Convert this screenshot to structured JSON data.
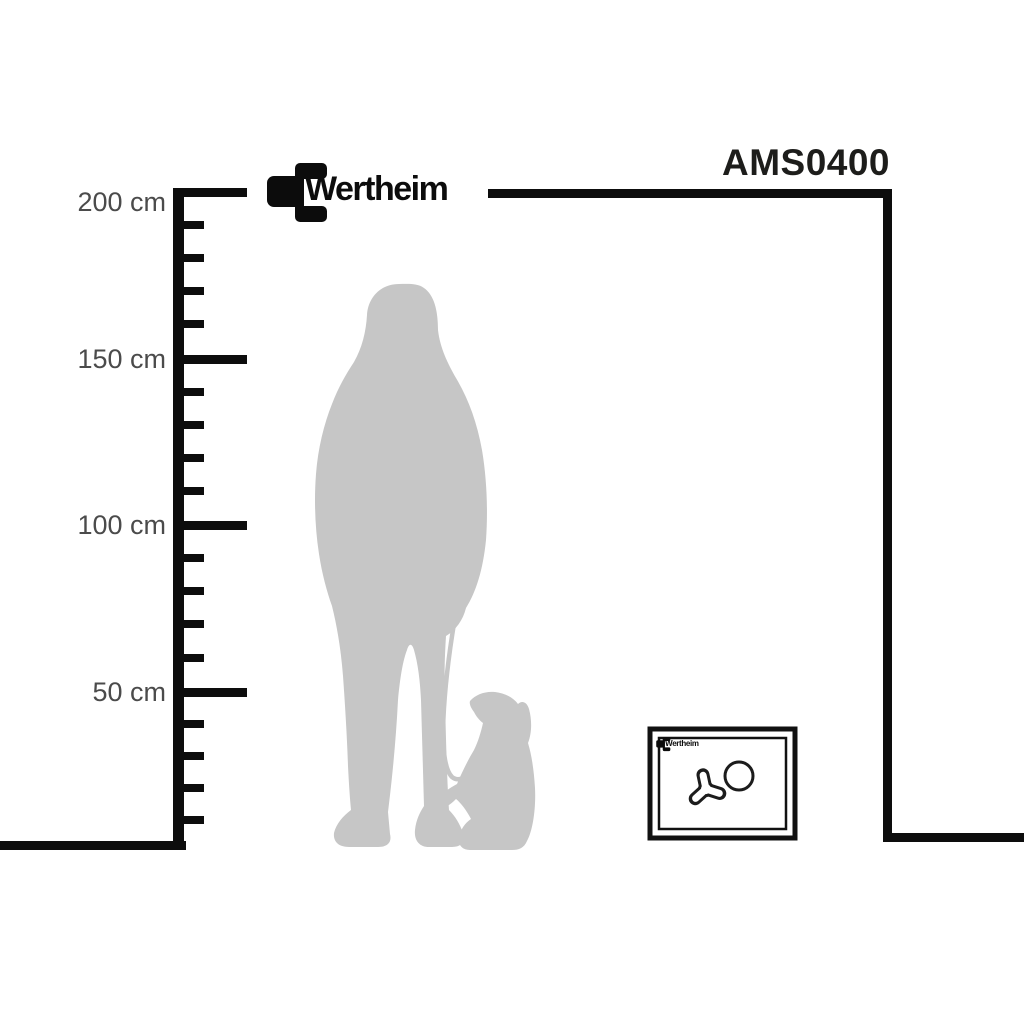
{
  "page": {
    "type": "product-size-comparison-diagram",
    "background": "#ffffff"
  },
  "brand": {
    "logo_text": "Wertheim"
  },
  "product": {
    "model": "AMS0400"
  },
  "ruler": {
    "unit": "cm",
    "labels": [
      {
        "value": 200,
        "text": "200 cm",
        "top": 186
      },
      {
        "value": 150,
        "text": "150 cm",
        "top": 343
      },
      {
        "value": 100,
        "text": "100 cm",
        "top": 509
      },
      {
        "value": 50,
        "text": "50 cm",
        "top": 676
      }
    ],
    "major_tick_y": [
      192,
      359,
      525,
      692
    ],
    "minor_tick_y": [
      225,
      258,
      291,
      324,
      392,
      425,
      458,
      491,
      558,
      591,
      624,
      658,
      724,
      756,
      788,
      820
    ],
    "minor_tick_step_cm": 10
  },
  "figures": {
    "person": "standing-woman-silhouette",
    "dog": "sitting-dog-silhouette",
    "leash": "dog-leash",
    "safe": "wertheim-safe-front-view"
  },
  "colors": {
    "line": "#0d0d0d",
    "silhouette": "#c6c6c6",
    "ruler_label": "#4b4b4b",
    "model_text": "#1d1d1b"
  }
}
